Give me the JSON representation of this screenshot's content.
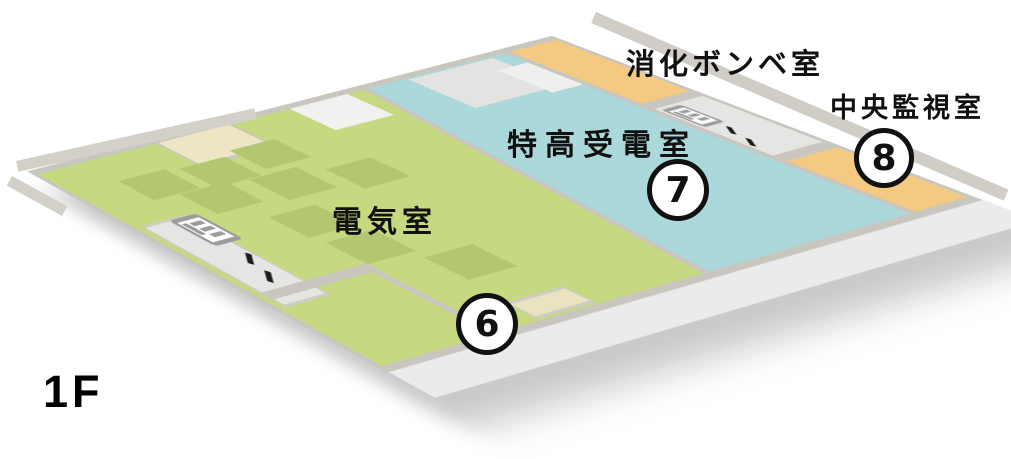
{
  "floor_label": "1F",
  "rooms": [
    {
      "id": "electrical-room",
      "name": "電気室",
      "number": "6",
      "color": "#c6d981"
    },
    {
      "id": "extra-high-voltage-receiving-room",
      "name": "特高受電室",
      "number": "7",
      "color": "#abd8da"
    },
    {
      "id": "fire-cylinder-room",
      "name": "消化ボンベ室",
      "number": "",
      "color": "#f4c981"
    },
    {
      "id": "central-monitoring-room",
      "name": "中央監視室",
      "number": "8",
      "color": "#f4c981"
    }
  ],
  "icons": {
    "elevator": "elevator-icon",
    "stairs": "stairs-icon",
    "elevator_arrows_glyph": "↑↓"
  },
  "colors": {
    "floor_green": "#c6d981",
    "equipment_pad": "#b3c670",
    "room_blue": "#abd8da",
    "room_orange": "#f4c981",
    "storage_beige": "#ede6c4",
    "wall_gray": "#c9c6bf",
    "walkway_gray": "#d3d0c9",
    "lobby_gray": "#e5e5e3",
    "slab_gray": "#ebebeb",
    "text_black": "#111111"
  }
}
